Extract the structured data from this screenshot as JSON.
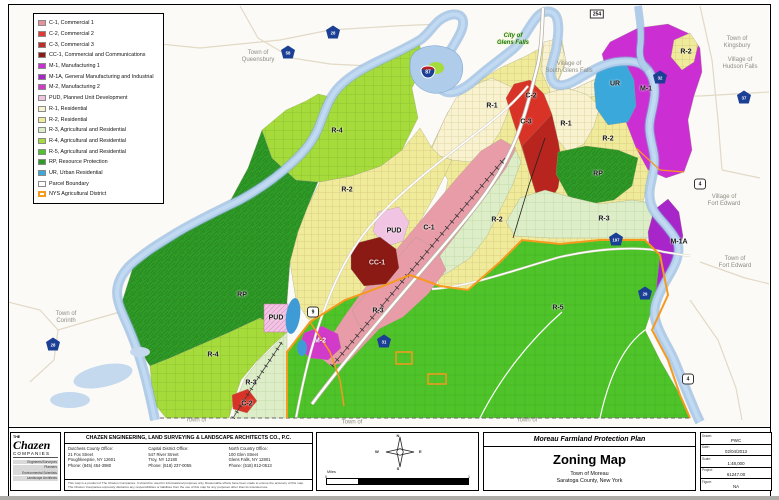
{
  "legend": {
    "items": [
      {
        "label": "C-1, Commercial 1",
        "color": "#E8919B"
      },
      {
        "label": "C-2, Commercial 2",
        "color": "#E23A2E"
      },
      {
        "label": "C-3, Commercial 3",
        "color": "#C22C24"
      },
      {
        "label": "CC-1, Commercial and Communications",
        "color": "#8C1A14"
      },
      {
        "label": "M-1, Manufacturing 1",
        "color": "#CB2FD3"
      },
      {
        "label": "M-1A, General Manufacturing and Industrial",
        "color": "#A825C9"
      },
      {
        "label": "M-2, Manufacturing 2",
        "color": "#D23BC9"
      },
      {
        "label": "PUD, Planned Unit Development",
        "color": "#F2C4E3"
      },
      {
        "label": "R-1, Residential",
        "color": "#F8F2D0"
      },
      {
        "label": "R-2, Residential",
        "color": "#F0EA9B"
      },
      {
        "label": "R-3, Agricultural and Residential",
        "color": "#DCEDC8"
      },
      {
        "label": "R-4, Agricultural and Residential",
        "color": "#A6DB3C"
      },
      {
        "label": "R-5, Agricultural and Residential",
        "color": "#4FC32A"
      },
      {
        "label": "RP, Resource Protection",
        "color": "#2F9B27"
      },
      {
        "label": "UR, Urban Residential",
        "color": "#3BA8DB"
      },
      {
        "label": "Parcel Boundary",
        "color": "#FFFFFF"
      },
      {
        "label": "NYS Agricultural District",
        "color": "#FFFFFF",
        "border": "#F5991F",
        "bw": 2
      }
    ]
  },
  "map": {
    "zone_labels": [
      {
        "t": "R-4",
        "x": 337,
        "y": 131
      },
      {
        "t": "R-2",
        "x": 347,
        "y": 190
      },
      {
        "t": "R-1",
        "x": 492,
        "y": 106
      },
      {
        "t": "C-2",
        "x": 531,
        "y": 96
      },
      {
        "t": "C-3",
        "x": 526,
        "y": 122
      },
      {
        "t": "R-1",
        "x": 566,
        "y": 124
      },
      {
        "t": "R-2",
        "x": 608,
        "y": 139
      },
      {
        "t": "UR",
        "x": 615,
        "y": 84
      },
      {
        "t": "M-1",
        "x": 646,
        "y": 89
      },
      {
        "t": "R-2",
        "x": 686,
        "y": 52
      },
      {
        "t": "RP",
        "x": 598,
        "y": 174
      },
      {
        "t": "R-3",
        "x": 604,
        "y": 219
      },
      {
        "t": "R-2",
        "x": 497,
        "y": 220
      },
      {
        "t": "M-1A",
        "x": 679,
        "y": 242
      },
      {
        "t": "C-1",
        "x": 429,
        "y": 228
      },
      {
        "t": "PUD",
        "x": 394,
        "y": 231
      },
      {
        "t": "CC-1",
        "x": 377,
        "y": 263,
        "cls": "cc1"
      },
      {
        "t": "RP",
        "x": 242,
        "y": 295
      },
      {
        "t": "PUD",
        "x": 276,
        "y": 318
      },
      {
        "t": "R-4",
        "x": 213,
        "y": 355
      },
      {
        "t": "M-2",
        "x": 320,
        "y": 341,
        "cls": "inv"
      },
      {
        "t": "R-3",
        "x": 378,
        "y": 311
      },
      {
        "t": "R-3",
        "x": 251,
        "y": 383
      },
      {
        "t": "R-5",
        "x": 558,
        "y": 308
      },
      {
        "t": "C-2",
        "x": 247,
        "y": 404
      }
    ],
    "place_labels": [
      {
        "t": "Town of\nQueensbury",
        "x": 258,
        "y": 57
      },
      {
        "t": "City of\nGlens Falls",
        "x": 513,
        "y": 40,
        "cls": "city"
      },
      {
        "t": "Village of\nSouth Glens Falls",
        "x": 569,
        "y": 68
      },
      {
        "t": "Town of\nKingsbury",
        "x": 737,
        "y": 43
      },
      {
        "t": "Village of\nHudson Falls",
        "x": 740,
        "y": 64
      },
      {
        "t": "Village of\nFort Edward",
        "x": 724,
        "y": 201
      },
      {
        "t": "Town of\nFort Edward",
        "x": 735,
        "y": 263
      },
      {
        "t": "Town of\nCorinth",
        "x": 66,
        "y": 318
      },
      {
        "t": "Town of",
        "x": 196,
        "y": 421
      },
      {
        "t": "Town of",
        "x": 352,
        "y": 423
      },
      {
        "t": "Town of",
        "x": 527,
        "y": 421
      }
    ],
    "shields": [
      {
        "n": "87",
        "x": 428,
        "y": 72,
        "kind": "i"
      },
      {
        "n": "254",
        "x": 597,
        "y": 14,
        "kind": "rect"
      },
      {
        "n": "28",
        "x": 333,
        "y": 32,
        "kind": "pent"
      },
      {
        "n": "58",
        "x": 288,
        "y": 52,
        "kind": "pent"
      },
      {
        "n": "32",
        "x": 660,
        "y": 77,
        "kind": "pent"
      },
      {
        "n": "37",
        "x": 744,
        "y": 97,
        "kind": "pent"
      },
      {
        "n": "28",
        "x": 53,
        "y": 344,
        "kind": "pent"
      },
      {
        "n": "197",
        "x": 616,
        "y": 239,
        "kind": "pent"
      },
      {
        "n": "29",
        "x": 645,
        "y": 293,
        "kind": "pent"
      },
      {
        "n": "31",
        "x": 384,
        "y": 341,
        "kind": "pent"
      },
      {
        "n": "9",
        "x": 313,
        "y": 312,
        "kind": "us"
      },
      {
        "n": "4",
        "x": 700,
        "y": 184,
        "kind": "us"
      },
      {
        "n": "4",
        "x": 688,
        "y": 379,
        "kind": "us"
      }
    ]
  },
  "footer": {
    "logo": {
      "the": "THE",
      "name": "Chazen",
      "companies": "COMPANIES",
      "tags": [
        "Engineers/Surveyors",
        "Planners",
        "Environmental Scientists",
        "Landscape Architects"
      ]
    },
    "firm_header": "CHAZEN ENGINEERING, LAND SURVEYING & LANDSCAPE ARCHITECTS CO., P.C.",
    "offices": [
      {
        "name": "Dutchess County Office:",
        "line1": "21 Fox Street",
        "line2": "Poughkeepsie, NY 12601",
        "phone": "Phone: (845) 454-3980"
      },
      {
        "name": "Capital District Office:",
        "line1": "547 River Street",
        "line2": "Troy, NY 12180",
        "phone": "Phone: (518) 237-0055"
      },
      {
        "name": "North Country Office:",
        "line1": "100 Glen Street",
        "line2": "Glens Falls, NY 12801",
        "phone": "Phone: (518) 812-0513"
      }
    ],
    "disclaimer1": "This map is a product of The Chazen Companies. It should be used for informational purposes only. Reasonable efforts have been made to ensure the accuracy of this map.",
    "disclaimer2": "The Chazen Companies expressly disclaims any responsibilities or liabilities from the use of this map for any purposes other than its intended use.",
    "compass": {
      "n": "N",
      "e": "E",
      "s": "S",
      "w": "W",
      "miles": "Miles",
      "s0": "0",
      "s1": "1"
    },
    "title_block": {
      "plan": "Moreau Farmland Protection Plan",
      "title": "Zoning Map",
      "town": "Town of Moreau",
      "county": "Saratoga County, New York"
    },
    "fields": [
      {
        "label": "Drawn:",
        "value": "PWC"
      },
      {
        "label": "Date:",
        "value": "02/04/2013"
      },
      {
        "label": "Scale:",
        "value": "1:48,000"
      },
      {
        "label": "Project:",
        "value": "61247.00"
      },
      {
        "label": "Figure:",
        "value": "NA"
      }
    ]
  }
}
